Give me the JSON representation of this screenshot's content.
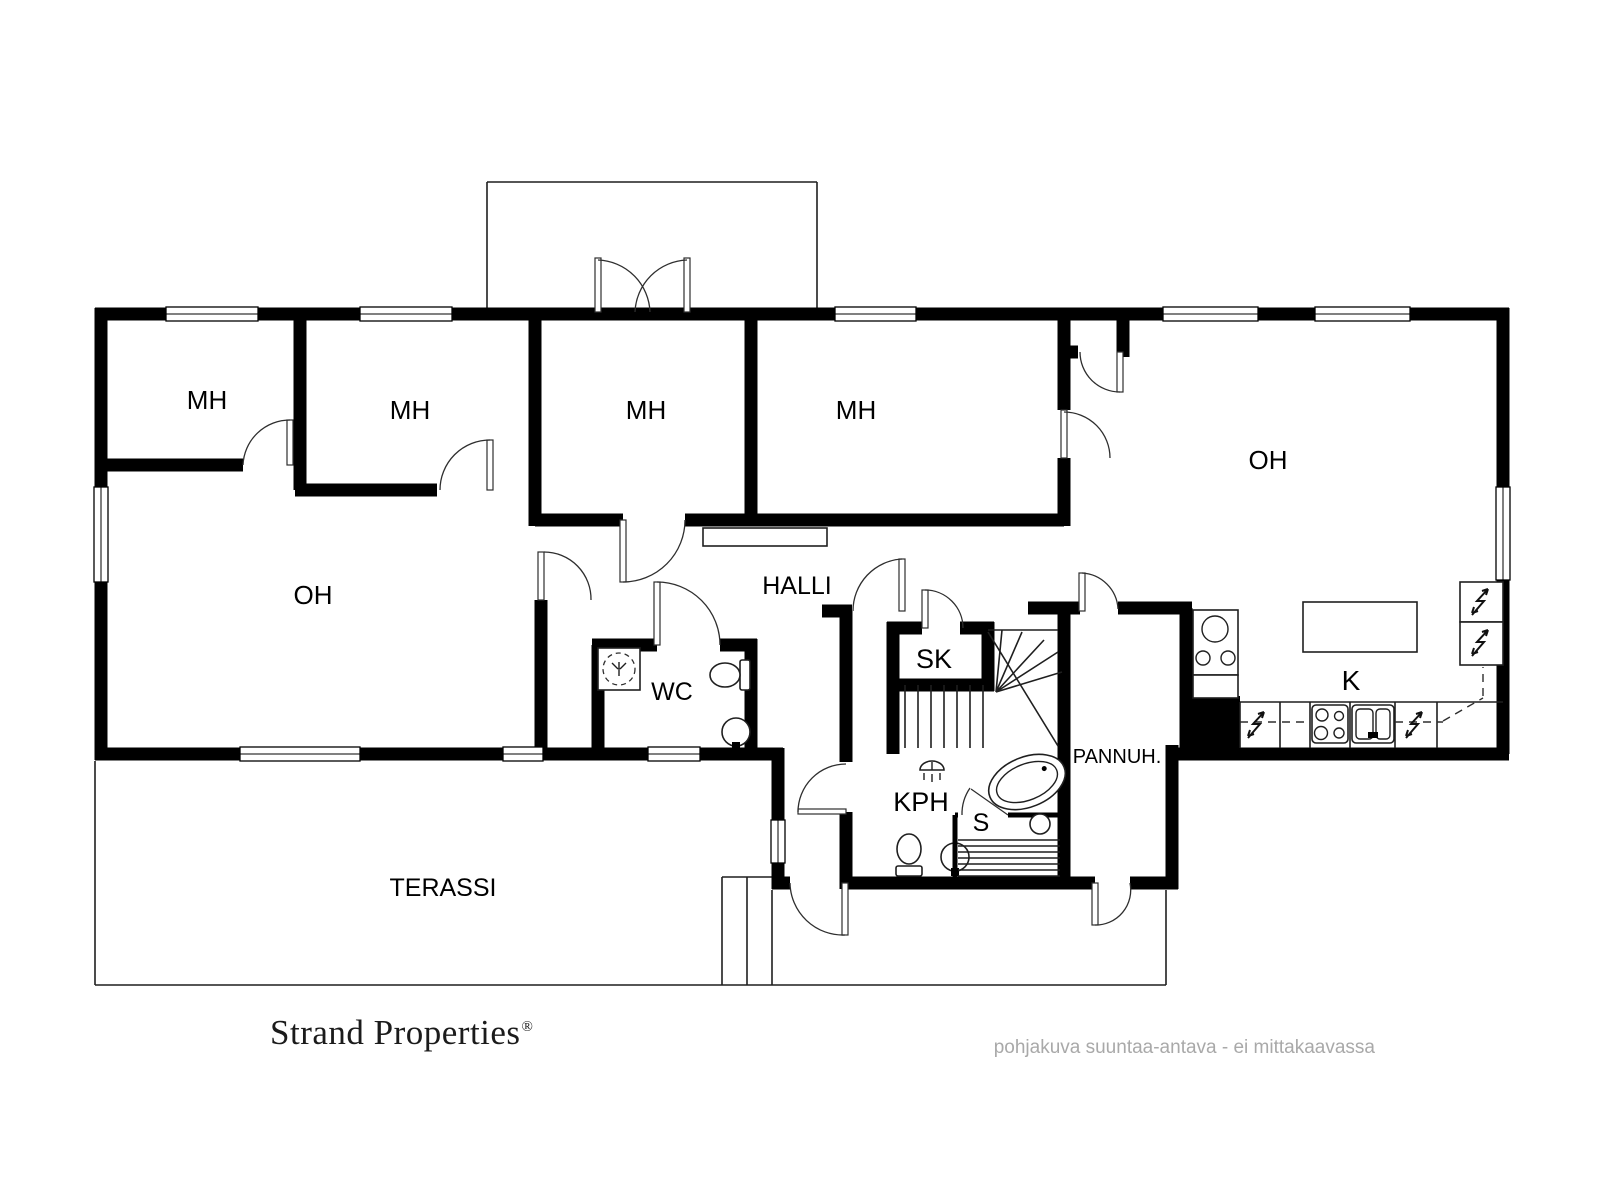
{
  "floorplan": {
    "type": "floor-plan",
    "rooms": {
      "mh1": "MH",
      "mh2": "MH",
      "mh3": "MH",
      "mh4": "MH",
      "oh_left": "OH",
      "oh_right": "OH",
      "halli": "HALLI",
      "wc": "WC",
      "sk": "SK",
      "kph": "KPH",
      "sauna": "S",
      "pannuh": "PANNUH.",
      "kitchen": "K",
      "terassi": "TERASSI"
    },
    "fixtures": [
      "window",
      "door-swing",
      "double-door",
      "stairs",
      "shower-icon",
      "toilet-icon",
      "sink-icon",
      "bathtub-icon",
      "sauna-stove-icon",
      "sauna-benches",
      "stove-icon",
      "cooktop-icon",
      "kitchen-sink-icon",
      "kitchen-island",
      "fridge-icon",
      "electrical-icon",
      "chimney-block"
    ],
    "colors": {
      "walls": "#000000",
      "background": "#ffffff"
    }
  },
  "footer": {
    "brand": "Strand Properties",
    "registered_mark": "®",
    "disclaimer": "pohjakuva suuntaa-antava - ei mittakaavassa",
    "disclaimer_color": "#a9a9a9"
  }
}
